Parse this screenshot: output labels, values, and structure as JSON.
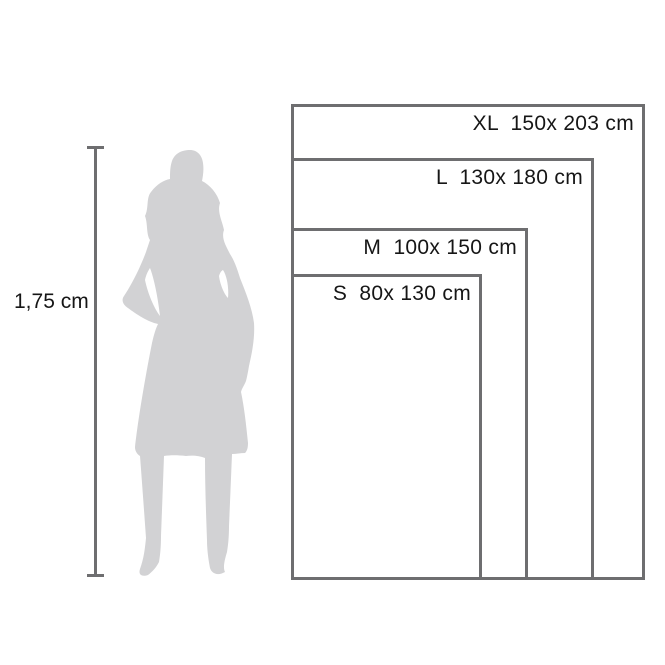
{
  "diagram": {
    "description": "blanket size chart with nested rectangles and human figure for scale",
    "height_reference": {
      "label": "1,75 cm"
    },
    "sizes": [
      {
        "id": "XL",
        "label": "XL  150x 203 cm",
        "size_code": "XL",
        "width_cm": 150,
        "height_cm": 203
      },
      {
        "id": "L",
        "label": "L  130x 180 cm",
        "size_code": "L",
        "width_cm": 130,
        "height_cm": 180
      },
      {
        "id": "M",
        "label": "M  100x 150 cm",
        "size_code": "M",
        "width_cm": 100,
        "height_cm": 150
      },
      {
        "id": "S",
        "label": "S  80x 130 cm",
        "size_code": "S",
        "width_cm": 80,
        "height_cm": 130
      }
    ],
    "colors": {
      "border": "#6e6e70",
      "silhouette": "#d2d2d4",
      "text": "#161616",
      "background": "#ffffff"
    }
  }
}
